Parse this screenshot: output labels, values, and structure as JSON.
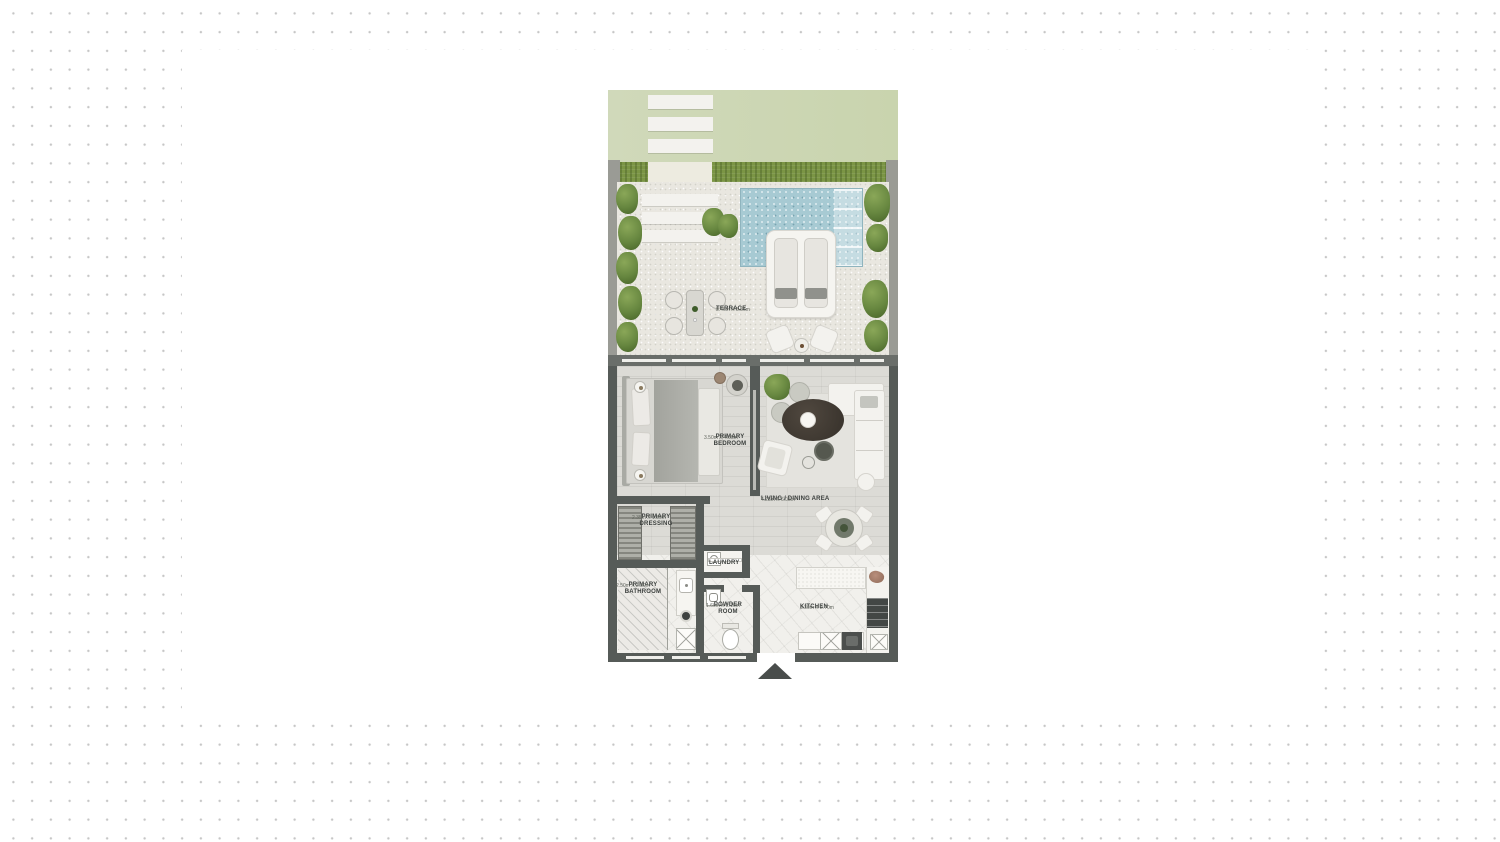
{
  "rooms": {
    "terrace": {
      "name": "TERRACE",
      "dims": "8.46m X 5.56m"
    },
    "primary_bedroom": {
      "name": "PRIMARY BEDROOM",
      "dims": "3.50m X 4.05m"
    },
    "living_dining": {
      "name": "LIVING / DINING AREA",
      "dims": "4.23m X 6.05m"
    },
    "primary_dressing": {
      "name": "PRIMARY DRESSING",
      "dims": "2.35m X 1.80m"
    },
    "laundry": {
      "name": "LAUNDRY"
    },
    "primary_bathroom": {
      "name": "PRIMARY BATHROOM",
      "dims": "2.50m X 2.30m"
    },
    "powder_room": {
      "name": "POWDER ROOM",
      "dims": "1.60m X 2.10m"
    },
    "kitchen": {
      "name": "KITCHEN",
      "dims": "3.30m X 2.70m"
    }
  },
  "colors": {
    "lawn": "#cdd6b3",
    "hedge": "#7b9545",
    "pool_water": "#a7cad3",
    "terrace_floor": "#e9e7e0",
    "interior_wall": "#565b58",
    "wood_floor": "#dcdbd6",
    "marble_floor": "#f1f0ec",
    "background_dot": "#c6c6c6"
  }
}
